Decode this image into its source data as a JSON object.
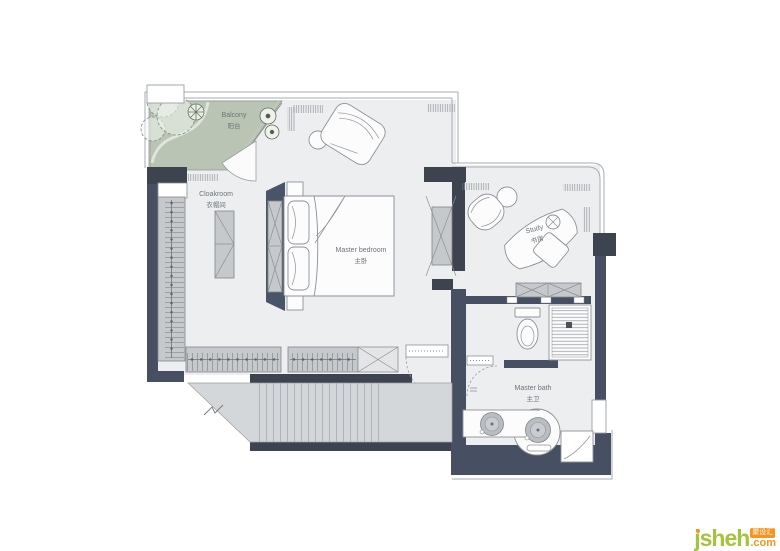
{
  "title": "Master suite floor plan",
  "rooms": {
    "balcony": {
      "en": "Balcony",
      "zh": "阳台"
    },
    "cloakroom": {
      "en": "Cloakroom",
      "zh": "衣帽间"
    },
    "master_bedroom": {
      "en": "Master bedroom",
      "zh": "主卧"
    },
    "study": {
      "en": "Study",
      "zh": "书房"
    },
    "master_bath": {
      "en": "Master bath",
      "zh": "主卫"
    }
  },
  "watermark": {
    "brand": "jsheh",
    "tld": ".com",
    "badge": "聚设汇"
  },
  "colors": {
    "wall": "#475062",
    "floor": "#edeef0",
    "balcony_floor": "#b9c4b4",
    "stairs": "#d4d7da",
    "cabinet": "#c6c9cc",
    "brand_green": "#a4c43c",
    "brand_orange": "#f7941e"
  }
}
